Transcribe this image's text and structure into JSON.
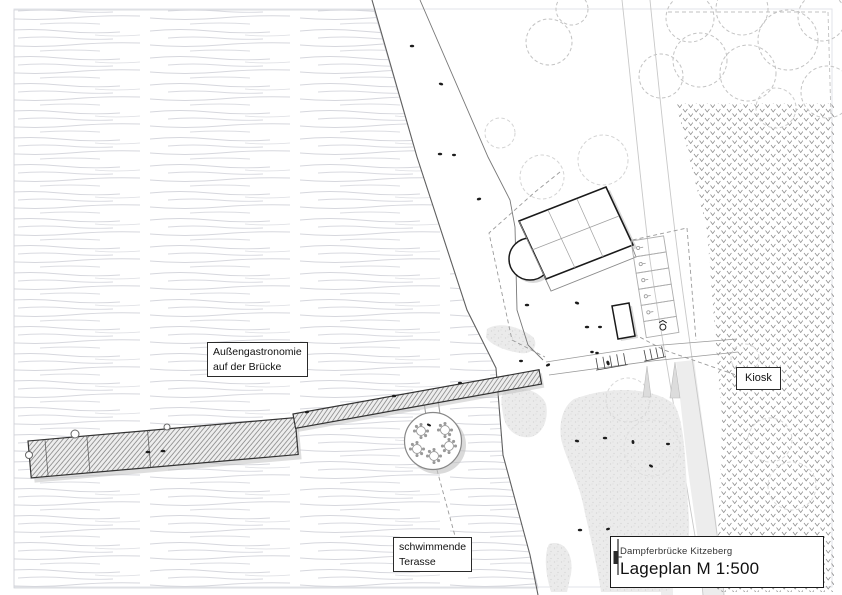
{
  "plan": {
    "labels": {
      "outdoor_gastronomy": {
        "line1": "Außengastronomie",
        "line2": "auf der Brücke"
      },
      "floating_terrace": {
        "line1": "schwimmende",
        "line2": "Terasse"
      },
      "kiosk": "Kiosk"
    },
    "title_block": {
      "project": "Dampferbrücke Kitzeberg",
      "sheet_title": "Lageplan M 1:500"
    },
    "colors": {
      "ink": "#1a1a1a",
      "water_line": "#d6d7dd",
      "shoreline": "#606060",
      "vegetation_mark": "#909090",
      "tree_outline": "#c3c3c3",
      "shadow": "#c5c5c5",
      "sand": "#ebebeb",
      "deck_hatch": "#7a7a7a"
    },
    "icons": {
      "title_block_icon": "pier-plan-icon"
    }
  }
}
